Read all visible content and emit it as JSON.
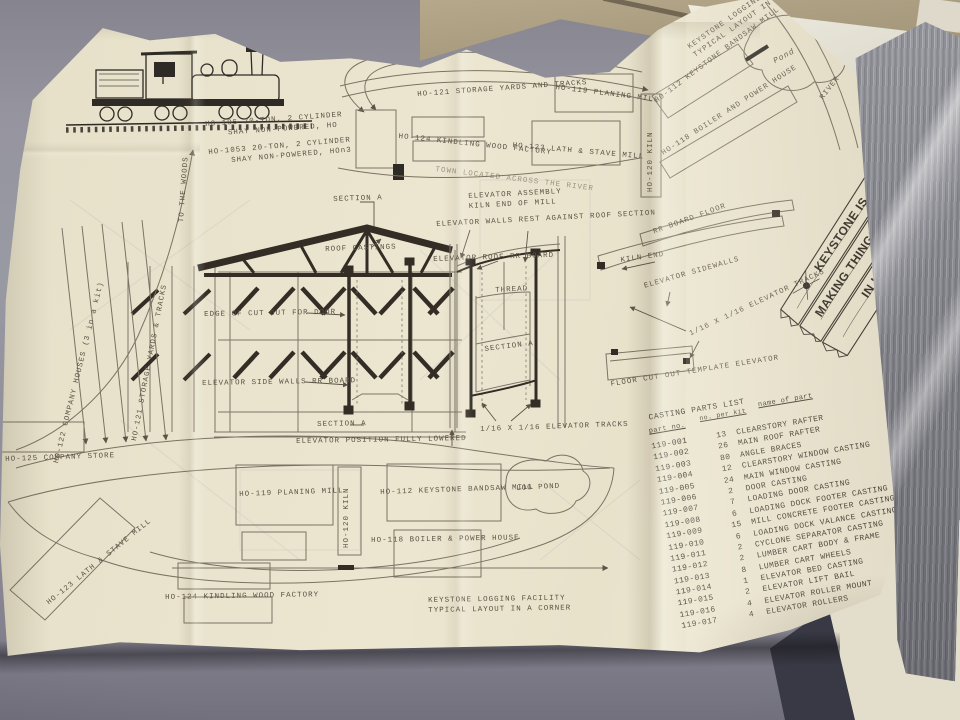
{
  "colors": {
    "paper": "#eae4cf",
    "ink": "#5b5143",
    "background": "#8f8e9a",
    "cardboard": "#ab9d80"
  },
  "locomotive": {
    "caption_ho": "HO-105 20-TON, 2 CYLINDER\n    SHAY NON-POWERED, HO",
    "caption_hon3": "HO-1053 20-TON, 2 CYLINDER\n    SHAY NON-POWERED, HOn3"
  },
  "valley_map": {
    "title": "KEYSTONE LOGGING FACILITY\nTYPICAL LAYOUT IN A VALLEY",
    "storage_yards": "HO-121 STORAGE YARDS AND TRACKS",
    "planing_mill": "HO-119 PLANING MILL",
    "kindling_factory": "HO-124 KINDLING WOOD FACTORY",
    "lath_stave_mill": "HO-123 LATH & STAVE MILL",
    "town_note": "TOWN LOCATED ACROSS THE RIVER",
    "kiln": "HO-120 KILN",
    "bandsaw_mill": "HO-112 KEYSTONE BANDSAW MILL",
    "boiler_house": "HO-118 BOILER AND POWER HOUSE",
    "pond": "Pond",
    "river": "RIVER"
  },
  "section_view": {
    "section_a_top": "SECTION A",
    "roof_castings": "ROOF CASTINGS",
    "door_cutout": "EDGE OF CUT OUT FOR DOOR",
    "side_walls": "ELEVATOR SIDE WALLS RR BOARD",
    "section_a_bottom": "SECTION A",
    "elevator_lowered": "ELEVATOR POSITION FULLY LOWERED"
  },
  "elevator_assembly": {
    "title": "ELEVATOR ASSEMBLY\nKILN END OF MILL",
    "walls_note": "ELEVATOR WALLS REST AGAINST ROOF SECTION",
    "roof_board": "ELEVATOR ROOF RR BOARD",
    "thread": "THREAD",
    "section_a": "SECTION A",
    "tracks": "1/16 X 1/16 ELEVATOR TRACKS"
  },
  "kiln_end_view": {
    "rr_board_floor": "RR BOARD FLOOR",
    "kiln_end": "KILN END",
    "sidewalls": "ELEVATOR SIDEWALLS",
    "tracks": "1/16 X 1/16 ELEVATOR TRACKS",
    "floor_template": "FLOOR CUT OUT TEMPLATE ELEVATOR"
  },
  "banner": {
    "line1": "KEYSTONE IS",
    "line2": "MAKING THINGS HAPPEN",
    "line3": "IN LOGGING"
  },
  "corner_map": {
    "to_the_woods": "TO THE WOODS",
    "company_houses": "HO-122 COMPANY HOUSES (3 in a kit)",
    "storage_yards": "HO-121 STORAGE YARDS & TRACKS",
    "company_store": "HO-125 COMPANY STORE",
    "lath_stave_mill": "HO-123 LATH & STAVE MILL",
    "planing_mill": "HO-119 PLANING MILL",
    "kiln": "HO-120 KILN",
    "bandsaw_mill": "HO-112 KEYSTONE BANDSAW MILL",
    "log_pond": "LOG POND",
    "boiler_house": "HO-118 BOILER & POWER HOUSE",
    "kindling_factory": "HO-124 KINDLING WOOD FACTORY",
    "caption": "KEYSTONE LOGGING FACILITY\nTYPICAL LAYOUT IN A CORNER"
  },
  "parts_list": {
    "title": "CASTING PARTS LIST",
    "col_part_no": "part no.",
    "col_qty": "no. per kit",
    "col_name": "name of part",
    "rows": [
      {
        "part": "119-001",
        "qty": "13",
        "name": "CLEARSTORY RAFTER"
      },
      {
        "part": "119-002",
        "qty": "26",
        "name": "MAIN ROOF RAFTER"
      },
      {
        "part": "119-003",
        "qty": "80",
        "name": "ANGLE BRACES"
      },
      {
        "part": "119-004",
        "qty": "12",
        "name": "CLEARSTORY WINDOW CASTING"
      },
      {
        "part": "119-005",
        "qty": "24",
        "name": "MAIN WINDOW CASTING"
      },
      {
        "part": "119-006",
        "qty": "2",
        "name": "DOOR CASTING"
      },
      {
        "part": "119-007",
        "qty": "7",
        "name": "LOADING DOOR CASTING"
      },
      {
        "part": "119-008",
        "qty": "6",
        "name": "LOADING DOCK FOOTER CASTING"
      },
      {
        "part": "119-009",
        "qty": "15",
        "name": "MILL CONCRETE FOOTER CASTING"
      },
      {
        "part": "119-010",
        "qty": "6",
        "name": "LOADING DOCK VALANCE CASTING"
      },
      {
        "part": "119-011",
        "qty": "2",
        "name": "CYCLONE SEPARATOR CASTING"
      },
      {
        "part": "119-012",
        "qty": "2",
        "name": "LUMBER CART BODY & FRAME"
      },
      {
        "part": "119-013",
        "qty": "8",
        "name": "LUMBER CART WHEELS"
      },
      {
        "part": "119-014",
        "qty": "1",
        "name": "ELEVATOR BED CASTING"
      },
      {
        "part": "119-015",
        "qty": "2",
        "name": "ELEVATOR LIFT BAIL"
      },
      {
        "part": "119-016",
        "qty": "4",
        "name": "ELEVATOR ROLLER MOUNT"
      },
      {
        "part": "119-017",
        "qty": "4",
        "name": "ELEVATOR ROLLERS"
      }
    ]
  }
}
